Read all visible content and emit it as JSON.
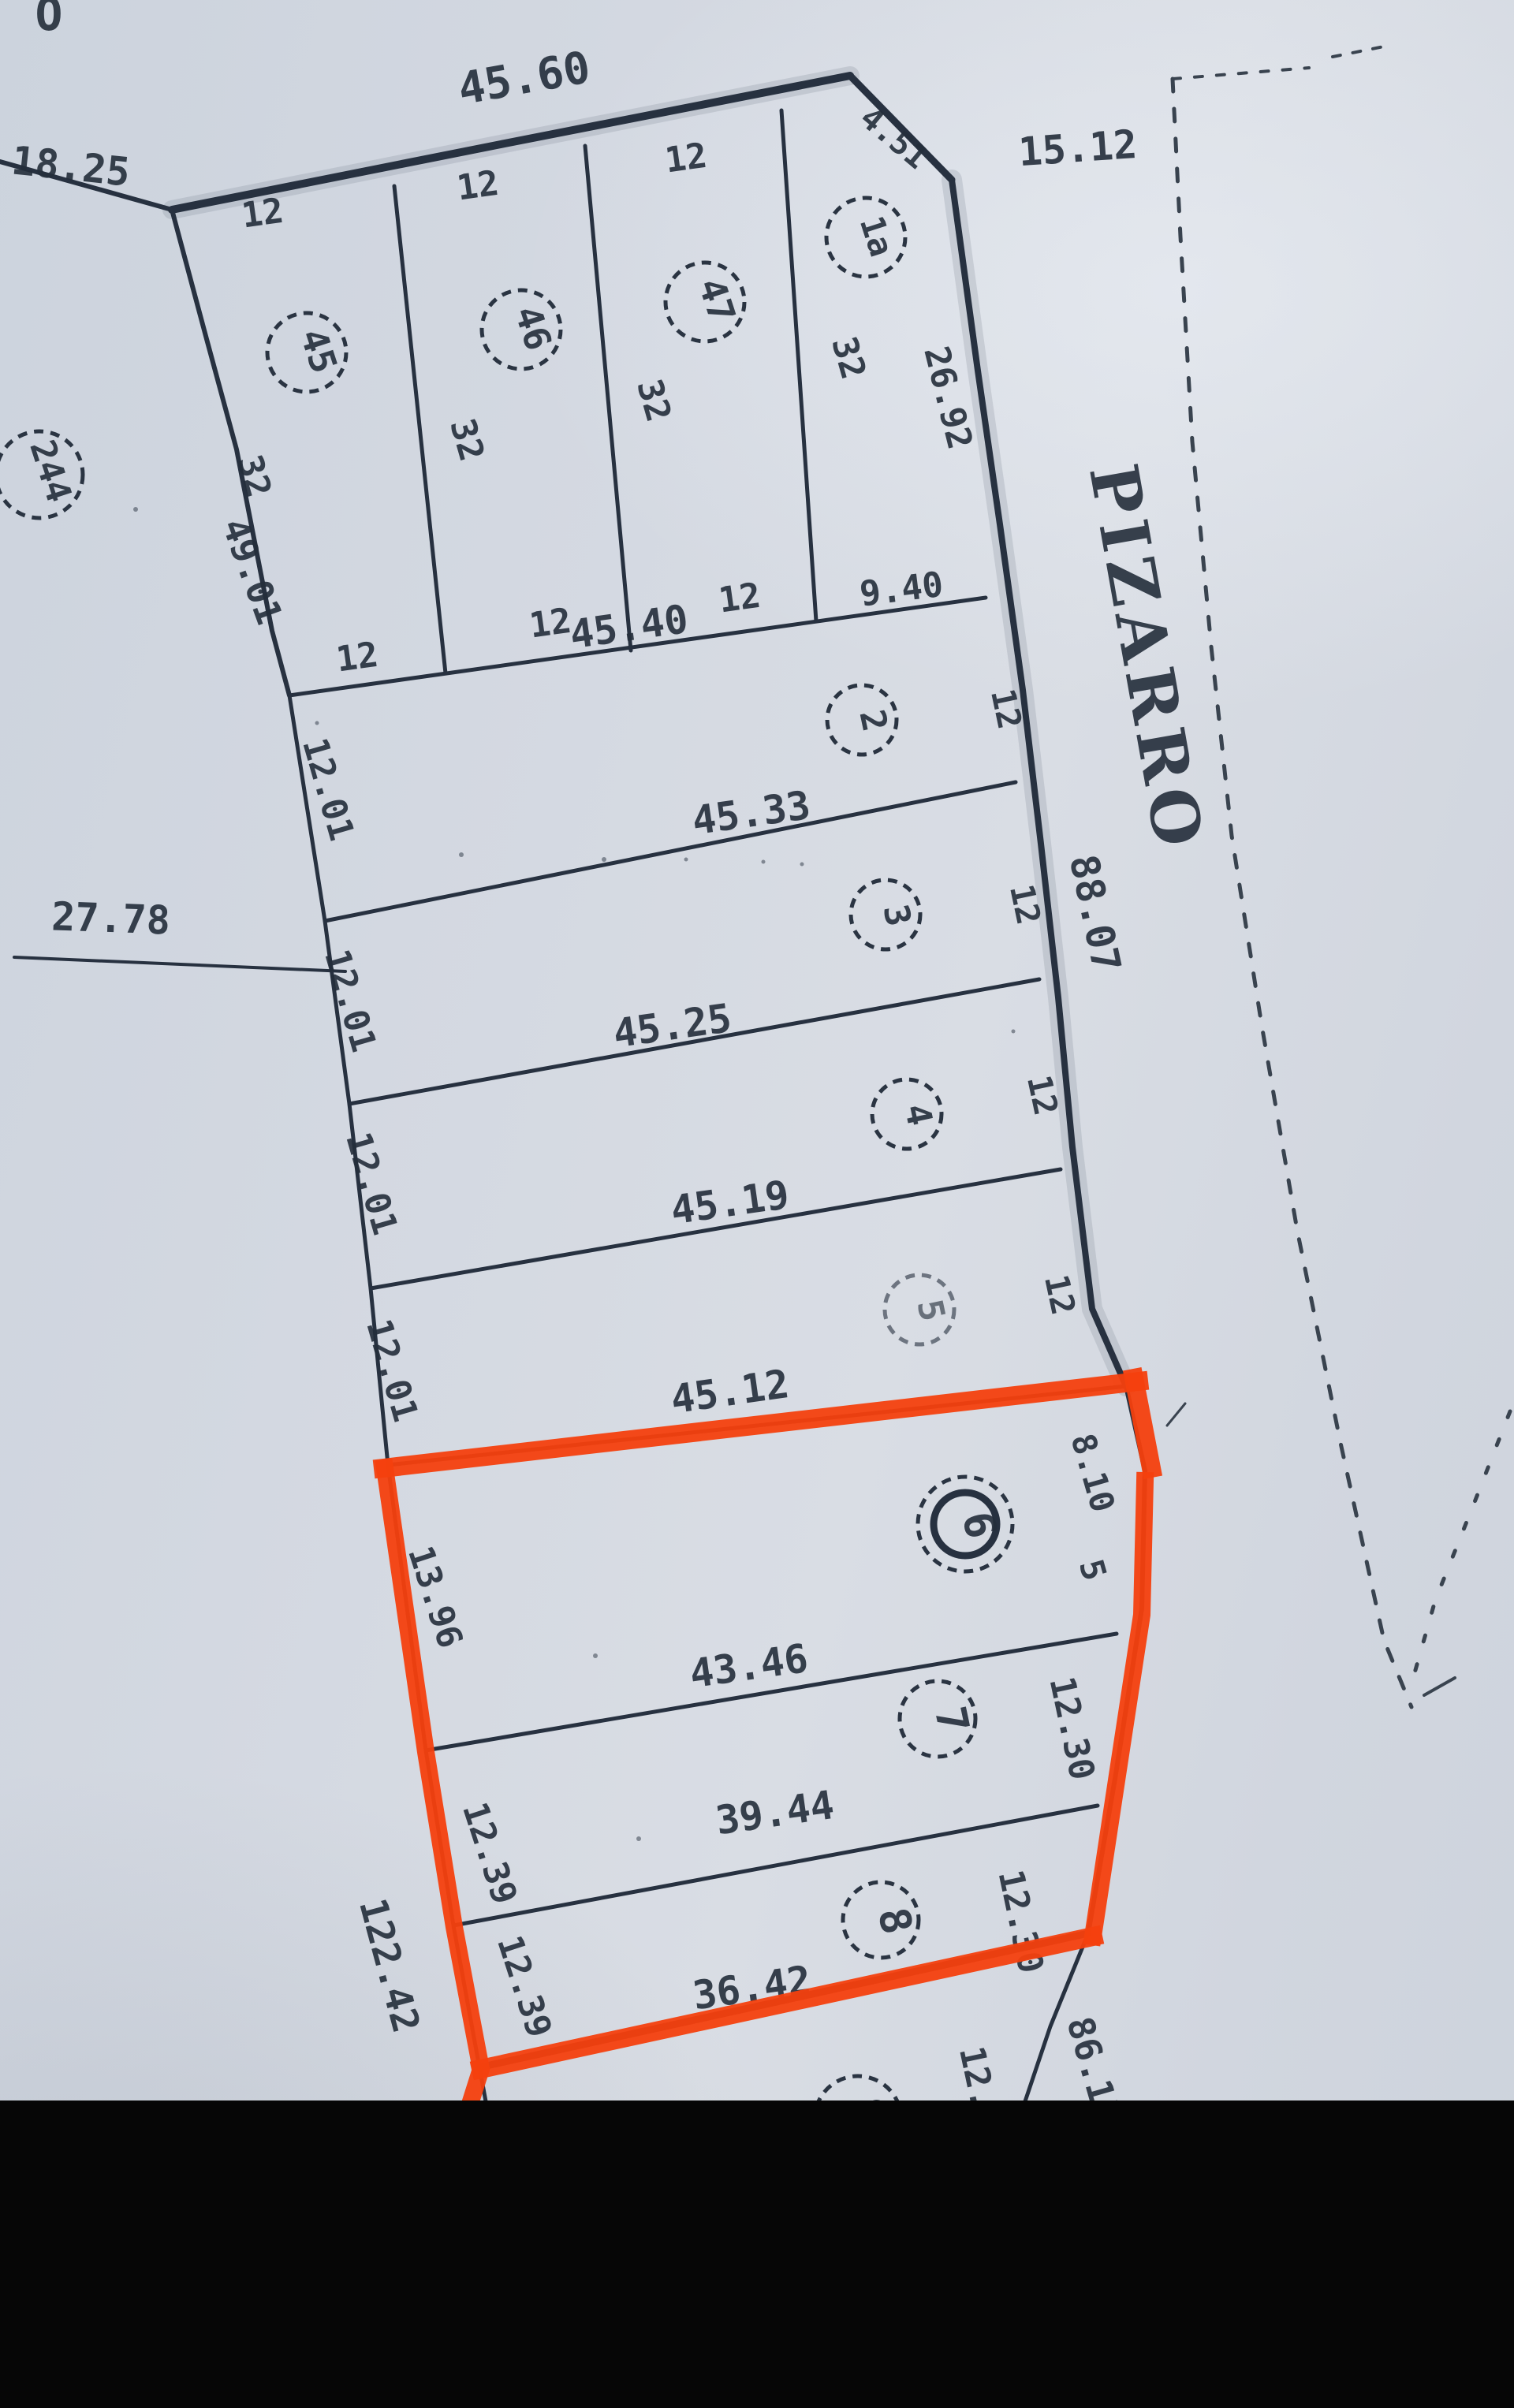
{
  "page": {
    "corner_fragment": "O",
    "street": {
      "name": "PIZARRO",
      "frontage_length": "88.07"
    },
    "highlight": {
      "color": "#f4400e",
      "outlined_lots": "6, 7, 8"
    }
  },
  "block_edges": {
    "top_width": "45.60",
    "top_right_chamfer": "4.51",
    "right_of_chamfer": "15.12",
    "left_top": "18.25",
    "left_upper_side": "49.01",
    "left_mid_tie": "27.78",
    "left_lower_total": "122.42",
    "street_lower": "86.17"
  },
  "top_row": {
    "neighbor_lot": "244",
    "lot_frontage": "12",
    "lot_depth": "32",
    "lots": [
      {
        "number": "45"
      },
      {
        "number": "46"
      },
      {
        "number": "47"
      },
      {
        "number": "1a"
      }
    ],
    "lot_1a_street_side": "26.92",
    "lot_1a_rear": "9.40"
  },
  "rows": [
    {
      "number": "2",
      "length": "45.40",
      "width_left": "12.01",
      "width_street": "12"
    },
    {
      "number": "3",
      "length": "45.33",
      "width_left": "12.01",
      "width_street": "12"
    },
    {
      "number": "4",
      "length": "45.25",
      "width_left": "12.01",
      "width_street": "12"
    },
    {
      "number": "5",
      "length": "45.19",
      "width_left": "12.01",
      "width_street": "12"
    },
    {
      "number": "6",
      "length": "45.12",
      "width_left": "13.96",
      "street_chamfer": "8.10",
      "street_chamfer_extra": "5"
    },
    {
      "number": "7",
      "length": "43.46",
      "width_left": "12.39",
      "width_street": "12.30"
    },
    {
      "number": "8",
      "length": "39.44",
      "width_left": "12.39",
      "width_street": "12.30",
      "bottom_length": "36.42"
    },
    {
      "number": "9",
      "width_street_partial": "12."
    }
  ]
}
